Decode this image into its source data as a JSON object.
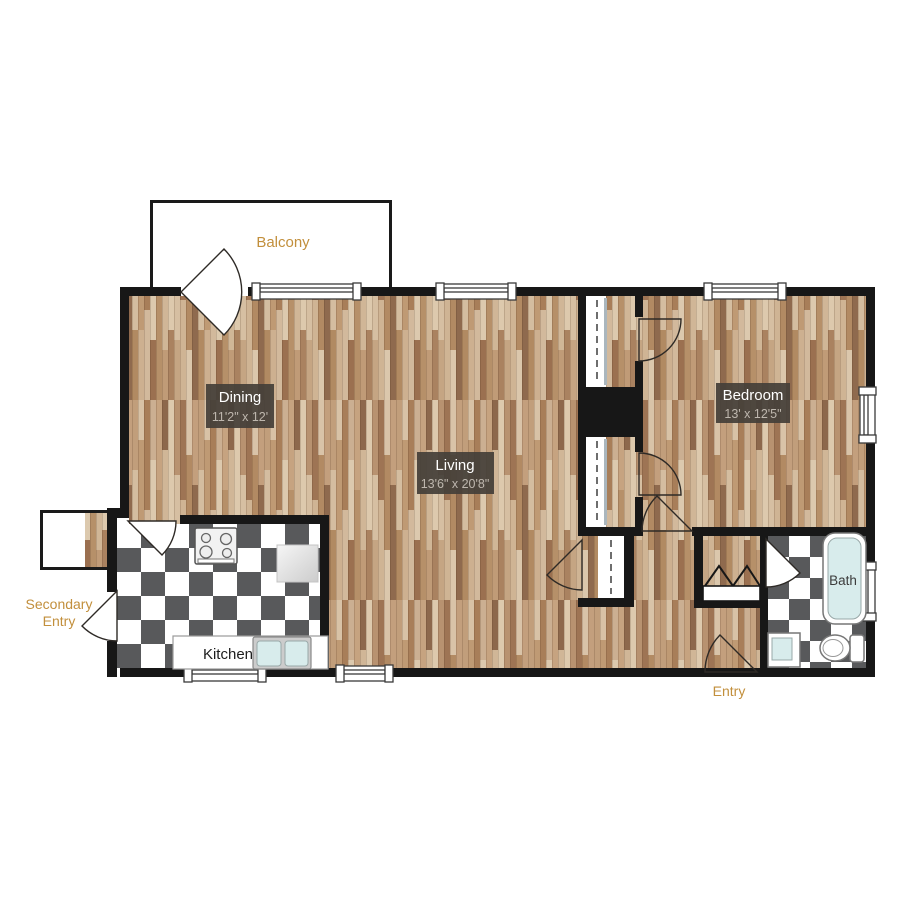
{
  "page": {
    "type": "apartment-floor-plan",
    "background": "#ffffff"
  },
  "colors": {
    "accent_orange": "#C28F3C",
    "wall_black": "#171717",
    "wood_base": "#C9AB8C",
    "tile_dark": "#58595B",
    "tile_light": "#FFFFFF",
    "fixture_water": "#D8ECEC",
    "label_box": "#454039",
    "label_name_text": "#FFFFFF",
    "label_dim_text": "#BEB7AE"
  },
  "rooms": {
    "balcony": {
      "name": "Balcony"
    },
    "dining": {
      "name": "Dining",
      "dims": "11'2\" x 12'"
    },
    "living": {
      "name": "Living",
      "dims": "13'6\" x 20'8\""
    },
    "bedroom": {
      "name": "Bedroom",
      "dims": "13' x 12'5\""
    },
    "kitchen": {
      "name": "Kitchen"
    },
    "bath": {
      "name": "Bath"
    }
  },
  "entries": {
    "entry": {
      "label": "Entry"
    },
    "secondary_entry": {
      "line1": "Secondary",
      "line2": "Entry"
    }
  }
}
